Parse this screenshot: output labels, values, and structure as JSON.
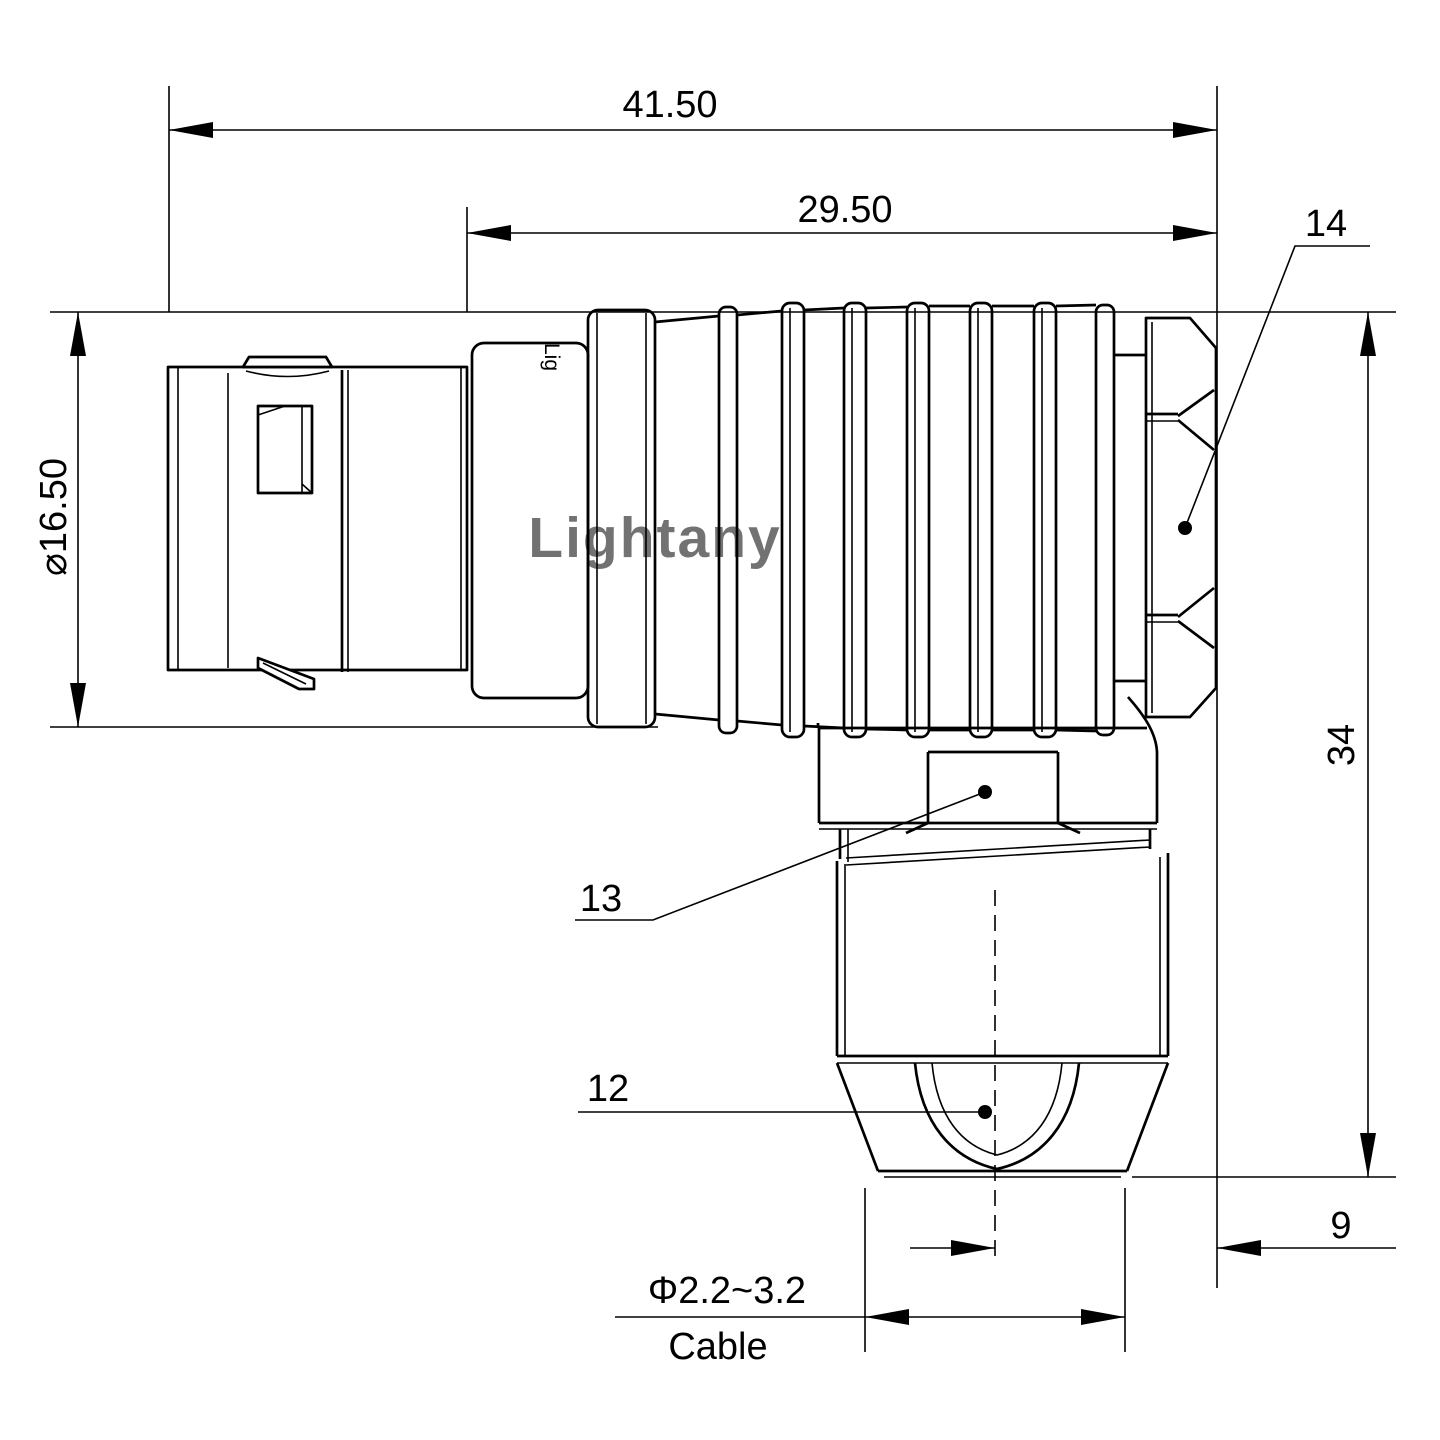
{
  "watermark": "Lightany",
  "brand_mark": "Lig",
  "dims": {
    "overall_length": "41.50",
    "insert_length": "29.50",
    "shell_diameter": "⌀16.50",
    "overall_height": "34",
    "elbow_offset": "9",
    "cable_diameter": "Φ2.2~3.2",
    "cable_label": "Cable"
  },
  "labels": {
    "back_nut": "14",
    "spanner_flats": "13",
    "cable_collet": "12"
  },
  "colors": {
    "line": "#000000",
    "watermark": "#efb9b9"
  }
}
